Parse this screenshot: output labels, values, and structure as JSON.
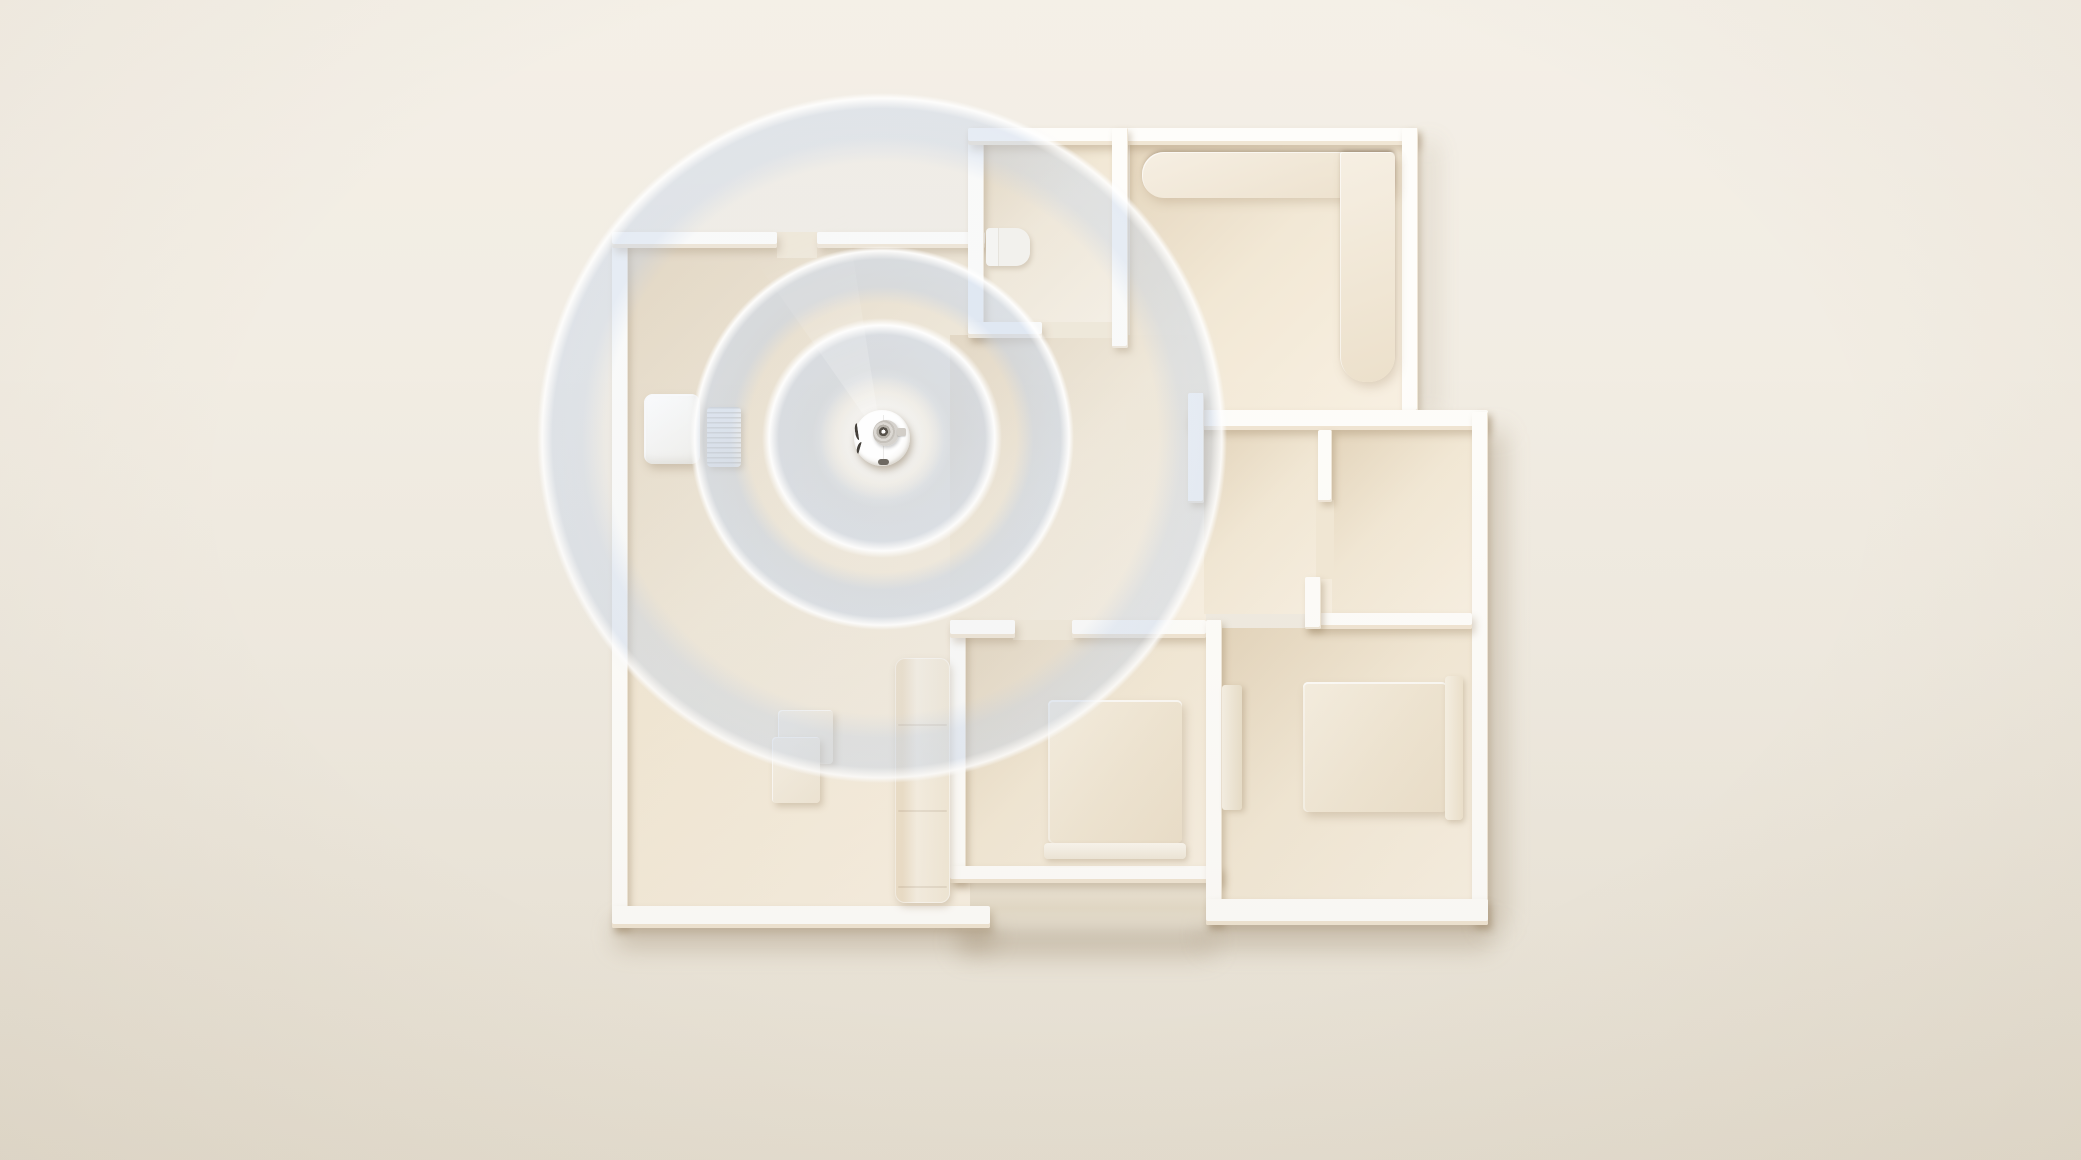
{
  "scene": {
    "description": "Top-down 3D render of a cream-colored apartment floor plan; a robot vacuum beside its charging dock emits concentric blue mapping signal rings in the living room",
    "style": "minimal cream 3D architectural render, no visible text",
    "palette": {
      "background": "#f0ebe1",
      "floor": "#f2e8d5",
      "floor_dark": "#e4d5bc",
      "floor_light": "#f8f0e2",
      "wall": "#fefdfa",
      "wall_face": "#ecdfc9",
      "signal_blue": "#bccee9",
      "signal_edge": "#ffffff",
      "shadow": "#b8a686"
    }
  },
  "rooms": [
    {
      "name": "living-room"
    },
    {
      "name": "bathroom"
    },
    {
      "name": "lounge"
    },
    {
      "name": "study"
    },
    {
      "name": "bedroom-middle"
    },
    {
      "name": "bedroom-right"
    },
    {
      "name": "hallway"
    },
    {
      "name": "entry"
    }
  ],
  "furniture": [
    {
      "name": "toilet"
    },
    {
      "name": "l-shaped-sofa"
    },
    {
      "name": "living-sofa"
    },
    {
      "name": "coffee-table"
    },
    {
      "name": "bed-middle"
    },
    {
      "name": "bed-right"
    },
    {
      "name": "wardrobe"
    },
    {
      "name": "charging-dock"
    },
    {
      "name": "dock-pad"
    }
  ],
  "robot": {
    "name": "robot-vacuum",
    "center_x": 882,
    "center_y": 438,
    "radius": 28,
    "glow_radius": 70,
    "veil_radius": 352,
    "signal_rings": [
      {
        "radius": 120
      },
      {
        "radius": 192
      },
      {
        "radius": 345
      }
    ]
  }
}
